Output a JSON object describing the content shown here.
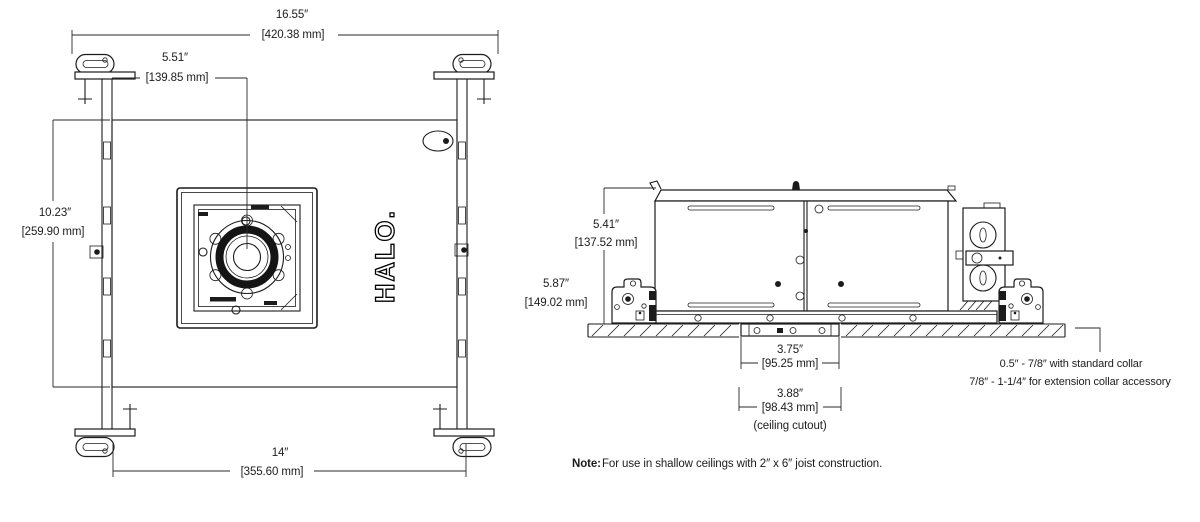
{
  "drawing": {
    "brand_vertical": "HALO.",
    "plan_view": {
      "overall_width_in": "16.55″",
      "overall_width_mm": "[420.38 mm]",
      "center_offset_in": "5.51″",
      "center_offset_mm": "[139.85 mm]",
      "frame_depth_in": "10.23″",
      "frame_depth_mm": "[259.90 mm]",
      "frame_width_in": "14″",
      "frame_width_mm": "[355.60 mm]"
    },
    "side_view": {
      "housing_height_in": "5.41″",
      "housing_height_mm": "[137.52 mm]",
      "overall_height_in": "5.87″",
      "overall_height_mm": "[149.02 mm]",
      "collar_width_in": "3.75″",
      "collar_width_mm": "[95.25 mm]",
      "cutout_width_in": "3.88″",
      "cutout_width_mm": "[98.43 mm]",
      "cutout_caption": "(ceiling cutout)",
      "collar_note_line1": "0.5″ - 7/8″ with standard collar",
      "collar_note_line2": "7/8″ - 1-1/4″ for extension collar accessory"
    },
    "footnote_label": "Note:",
    "footnote_text": "For use in shallow ceilings with 2″ x 6″ joist construction."
  }
}
